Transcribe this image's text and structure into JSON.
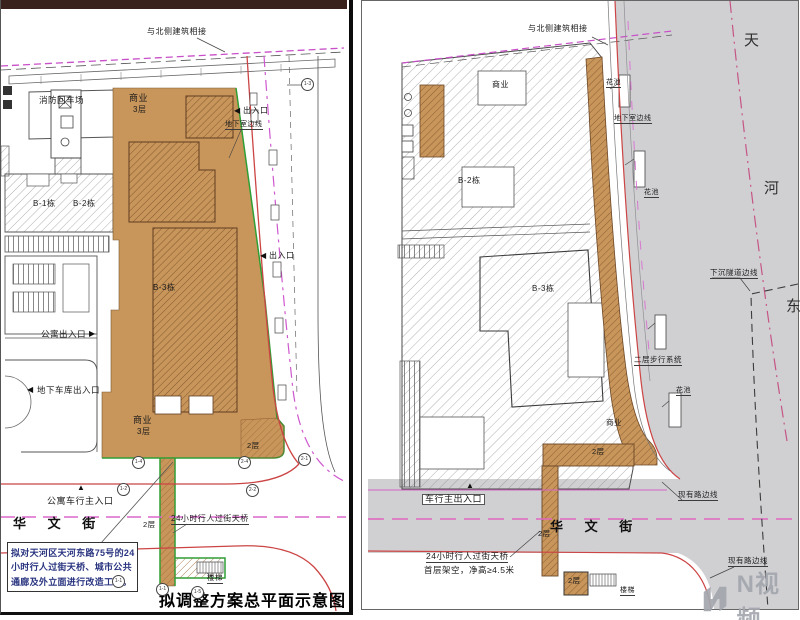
{
  "icons": {
    "arrow_left": "◀",
    "arrow_right": "▶",
    "arrow_up": "▲"
  },
  "colors": {
    "proposal_orange": "#c8955a",
    "outline_green": "#2f9f35",
    "curb_red": "#cc4444",
    "centerline_magenta": "#d45fc8",
    "road_gray": "#d0d0d3",
    "note_blue": "#2a3580",
    "top_bar": "#38221b"
  },
  "left_plan": {
    "caption": "拟调整方案总平面示意图",
    "north_link": "与北侧建筑相接",
    "fire_yard": "消防回车场",
    "biz_top_line1": "商业",
    "biz_top_line2": "3层",
    "b1": "B-1栋",
    "b2": "B-2栋",
    "b3": "B-3栋",
    "exit_top": "出入口",
    "exit_mid": "出入口",
    "basement_edge": "地下室边线",
    "apt_entrance": "公寓出入口",
    "garage_entrance": "地下车库出入口",
    "biz_bottom_line1": "商业",
    "biz_bottom_line2": "3层",
    "floor2_se": "2层",
    "floor2_bridge": "2层",
    "apt_vehicle_entrance": "公寓车行主入口",
    "street": "华 文 街",
    "bridge": "24小时行人过街天桥",
    "stairs": "楼梯",
    "note_line1": "拟对天河区天河东路75号的24",
    "note_line2": "小时行人过街天桥、城市公共",
    "note_line3": "通廊及外立面进行改造工程。",
    "markers": [
      "1-3",
      "1-4",
      "1-2",
      "2-4",
      "2-1",
      "2-2",
      "1-1",
      "1-1",
      "1-5"
    ]
  },
  "right_plan": {
    "north_link": "与北侧建筑相接",
    "biz_top": "商业",
    "flower_1": "花池",
    "flower_2": "花池",
    "flower_3": "花池",
    "basement_edge": "地下室边线",
    "tunnel_edge": "下沉隧道边线",
    "road_name_char1": "天",
    "road_name_char2": "河",
    "road_name_char3": "东",
    "ped_system": "二层步行系统",
    "b2": "B-2栋",
    "b3": "B-3栋",
    "biz": "商业",
    "floor2_bar": "2层",
    "floor2_bridge": "2层",
    "floor2_box": "2层",
    "vehicle_entrance": "车行主出入口",
    "street": "华 文 街",
    "bridge_line1": "24小时行人过街天桥",
    "bridge_line2": "首层架空，净高≥4.5米",
    "stairs": "楼梯",
    "existing_edge_1": "现有路边线",
    "existing_edge_2": "现有路边线"
  },
  "watermark": {
    "text": "N视频"
  }
}
